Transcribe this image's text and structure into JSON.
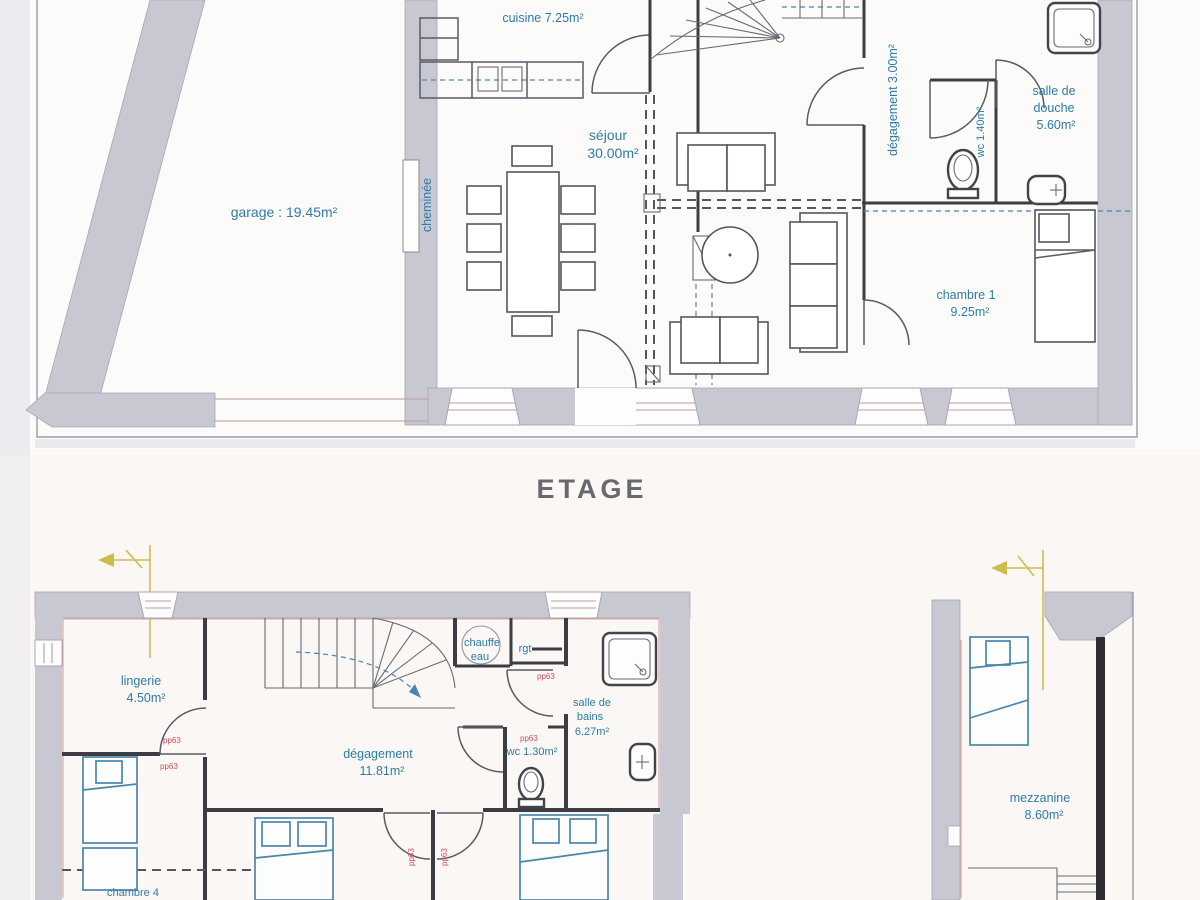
{
  "floor_title": "ETAGE",
  "colors": {
    "wall_gray": "#c7c8d2",
    "label_blue": "#2e7ba8",
    "door_tag_red": "#c84f63",
    "section_yellow": "#cdbd4e",
    "interior_wall_dark": "#3c3c44",
    "furniture_blue": "#4a86ac"
  },
  "ground_floor": {
    "rooms": {
      "garage": "garage : 19.45m²",
      "cuisine": "cuisine 7.25m²",
      "sejour_name": "séjour",
      "sejour_area": "30.00m²",
      "cheminee": "cheminée",
      "degagement": "dégagement 3.00m²",
      "wc": "wc 1.40m²",
      "salle_de_douche_l1": "salle de",
      "salle_de_douche_l2": "douche",
      "salle_de_douche_area": "5.60m²",
      "chambre1_name": "chambre 1",
      "chambre1_area": "9.25m²"
    }
  },
  "etage": {
    "rooms": {
      "lingerie_name": "lingerie",
      "lingerie_area": "4.50m²",
      "chauffe_eau_l1": "chauffe",
      "chauffe_eau_l2": "eau",
      "rgt": "rgt",
      "salle_de_bains_l1": "salle de",
      "salle_de_bains_l2": "bains",
      "salle_de_bains_area": "6.27m²",
      "wc": "wc 1.30m²",
      "degagement_name": "dégagement",
      "degagement_area": "11.81m²",
      "chambre4": "chambre 4",
      "mezzanine_name": "mezzanine",
      "mezzanine_area": "8.60m²"
    },
    "door_tag": "pp63"
  }
}
